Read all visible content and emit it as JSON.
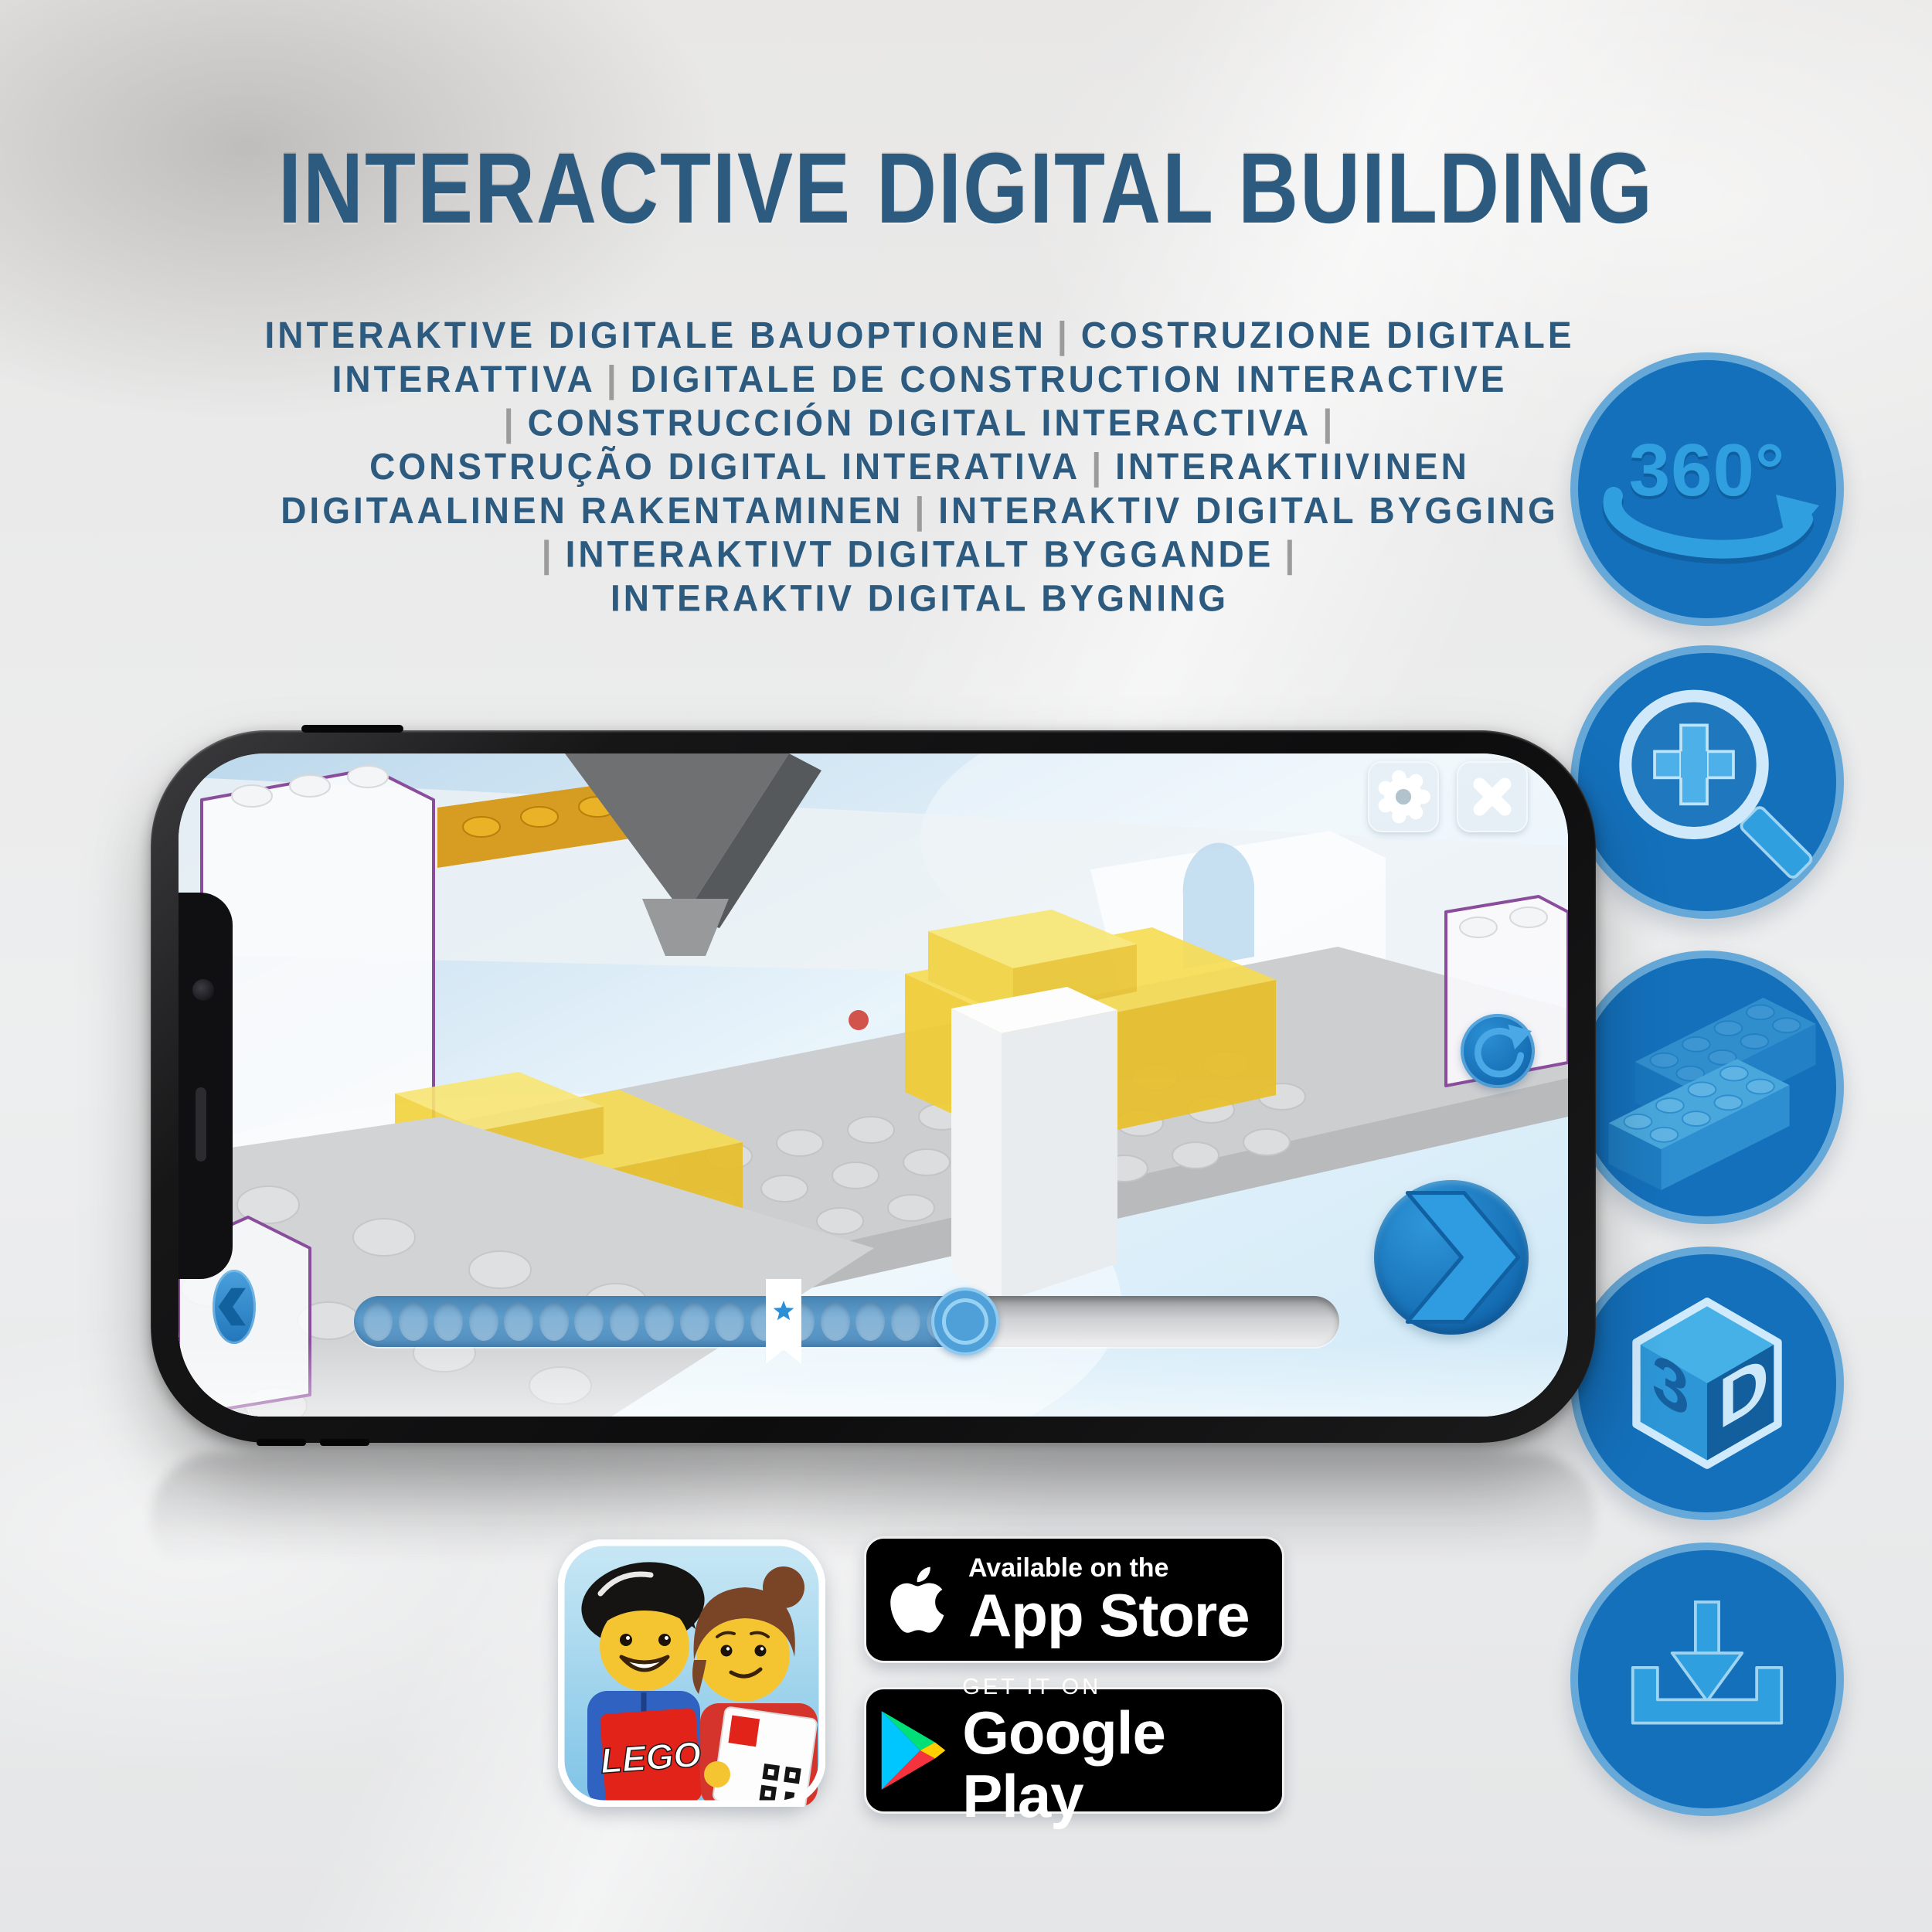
{
  "header": {
    "title": "INTERACTIVE DIGITAL BUILDING"
  },
  "subtitle": {
    "separator": "|",
    "lines": [
      "INTERAKTIVE DIGITALE BAUOPTIONEN | COSTRUZIONE DIGITALE",
      "INTERATTIVA | DIGITALE DE CONSTRUCTION INTERACTIVE",
      "| CONSTRUCCIÓN DIGITAL INTERACTIVA |",
      "CONSTRUÇÃO DIGITAL INTERATIVA | INTERAKTIIVINEN",
      "DIGITAALINEN RAKENTAMINEN | INTERAKTIV DIGITAL BYGGING",
      "| INTERAKTIVT DIGITALT BYGGANDE |",
      "INTERAKTIV DIGITAL BYGNING"
    ]
  },
  "features": [
    {
      "id": "view-360",
      "label": "360°"
    },
    {
      "id": "zoom-in",
      "label": ""
    },
    {
      "id": "brick-placement",
      "label": ""
    },
    {
      "id": "view-3d",
      "face_left": "3",
      "face_right": "D"
    },
    {
      "id": "download",
      "label": ""
    }
  ],
  "phone_app": {
    "toolbar": {
      "settings_icon": "gear",
      "close_icon": "x"
    },
    "controls": {
      "rotate_icon": "rotate-arrow",
      "previous_icon": "chevron-left",
      "next_icon": "chevron-right"
    },
    "progress": {
      "fill_percent": 62,
      "bookmark_percent": 43.6,
      "dot_count": 17
    }
  },
  "store": {
    "app_icon": {
      "logo_text": "LEGO"
    },
    "app_store": {
      "line1": "Available on the",
      "line2": "App Store"
    },
    "google_play": {
      "line1": "GET IT ON",
      "line2": "Google Play"
    }
  },
  "colors": {
    "title_blue": "#2d5b80",
    "separator_gray": "#9b9b9b",
    "feature_circle": "#1470bb",
    "feature_rim": "#66a9d9",
    "icon_light_blue": "#2f9fe0",
    "app_accent": "#2b8fd6",
    "lego_red": "#e2231a"
  }
}
